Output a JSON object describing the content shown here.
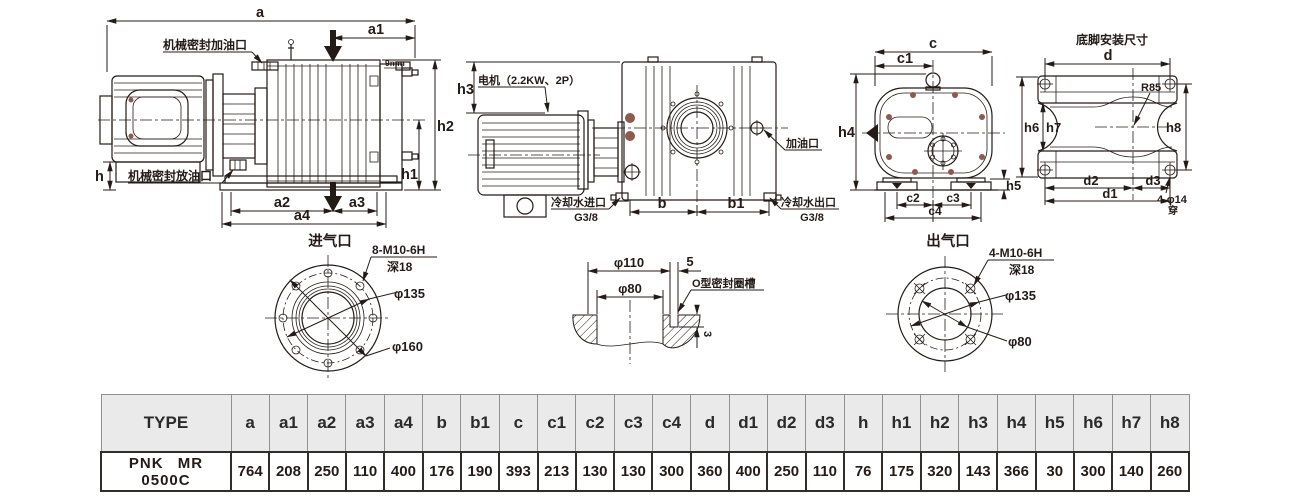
{
  "colors": {
    "line": "#241b17",
    "bolt_dot": "#8d5a50",
    "table_header_bg": "#eaeaea",
    "table_header_border": "#909090",
    "table_data_border": "#332d2a"
  },
  "side_view": {
    "dim_a": "a",
    "dim_a1": "a1",
    "dim_a2": "a2",
    "dim_a3": "a3",
    "dim_a4": "a4",
    "dim_h": "h",
    "dim_h1": "h1",
    "dim_h2": "h2",
    "label_seal_fill": "机械密封加油口",
    "label_seal_drain": "机械密封放油口",
    "label_note": "9mm"
  },
  "front_view": {
    "dim_h3": "h3",
    "dim_b": "b",
    "dim_b1": "b1",
    "label_motor": "电机（2.2KW、2P）",
    "label_oil_port": "加油口",
    "label_cool_in": "冷却水进口",
    "label_cool_in_thread": "G3/8",
    "label_cool_out": "冷却水出口",
    "label_cool_out_thread": "G3/8"
  },
  "end_view": {
    "dim_c": "c",
    "dim_c1": "c1",
    "dim_c2": "c2",
    "dim_c3": "c3",
    "dim_c4": "c4",
    "dim_h4": "h4",
    "dim_h5": "h5"
  },
  "foot_view": {
    "title": "底脚安装尺寸",
    "dim_d": "d",
    "dim_d1": "d1",
    "dim_d2": "d2",
    "dim_d3": "d3",
    "dim_h6": "h6",
    "dim_h7": "h7",
    "dim_h8": "h8",
    "label_radius": "R85",
    "label_holes": "4-φ14",
    "label_through": "穿"
  },
  "inlet_detail": {
    "title": "进气口",
    "label_bolts": "8-M10-6H",
    "label_depth": "深18",
    "dim_bolt_circle": "φ135",
    "dim_outer": "φ160"
  },
  "groove_detail": {
    "dim_outer": "φ110",
    "dim_width": "5",
    "dim_bore": "φ80",
    "label_groove": "O型密封圈槽",
    "dim_depth": "3"
  },
  "outlet_detail": {
    "title": "出气口",
    "label_bolts": "4-M10-6H",
    "label_depth": "深18",
    "dim_bolt_circle": "φ135",
    "dim_bore": "φ80"
  },
  "table": {
    "type_header": "TYPE",
    "type_value": "PNK MR 0500C",
    "headers": [
      "a",
      "a1",
      "a2",
      "a3",
      "a4",
      "b",
      "b1",
      "c",
      "c1",
      "c2",
      "c3",
      "c4",
      "d",
      "d1",
      "d2",
      "d3",
      "h",
      "h1",
      "h2",
      "h3",
      "h4",
      "h5",
      "h6",
      "h7",
      "h8"
    ],
    "values": [
      "764",
      "208",
      "250",
      "110",
      "400",
      "176",
      "190",
      "393",
      "213",
      "130",
      "130",
      "300",
      "360",
      "400",
      "250",
      "110",
      "76",
      "175",
      "320",
      "143",
      "366",
      "30",
      "300",
      "140",
      "260"
    ]
  }
}
